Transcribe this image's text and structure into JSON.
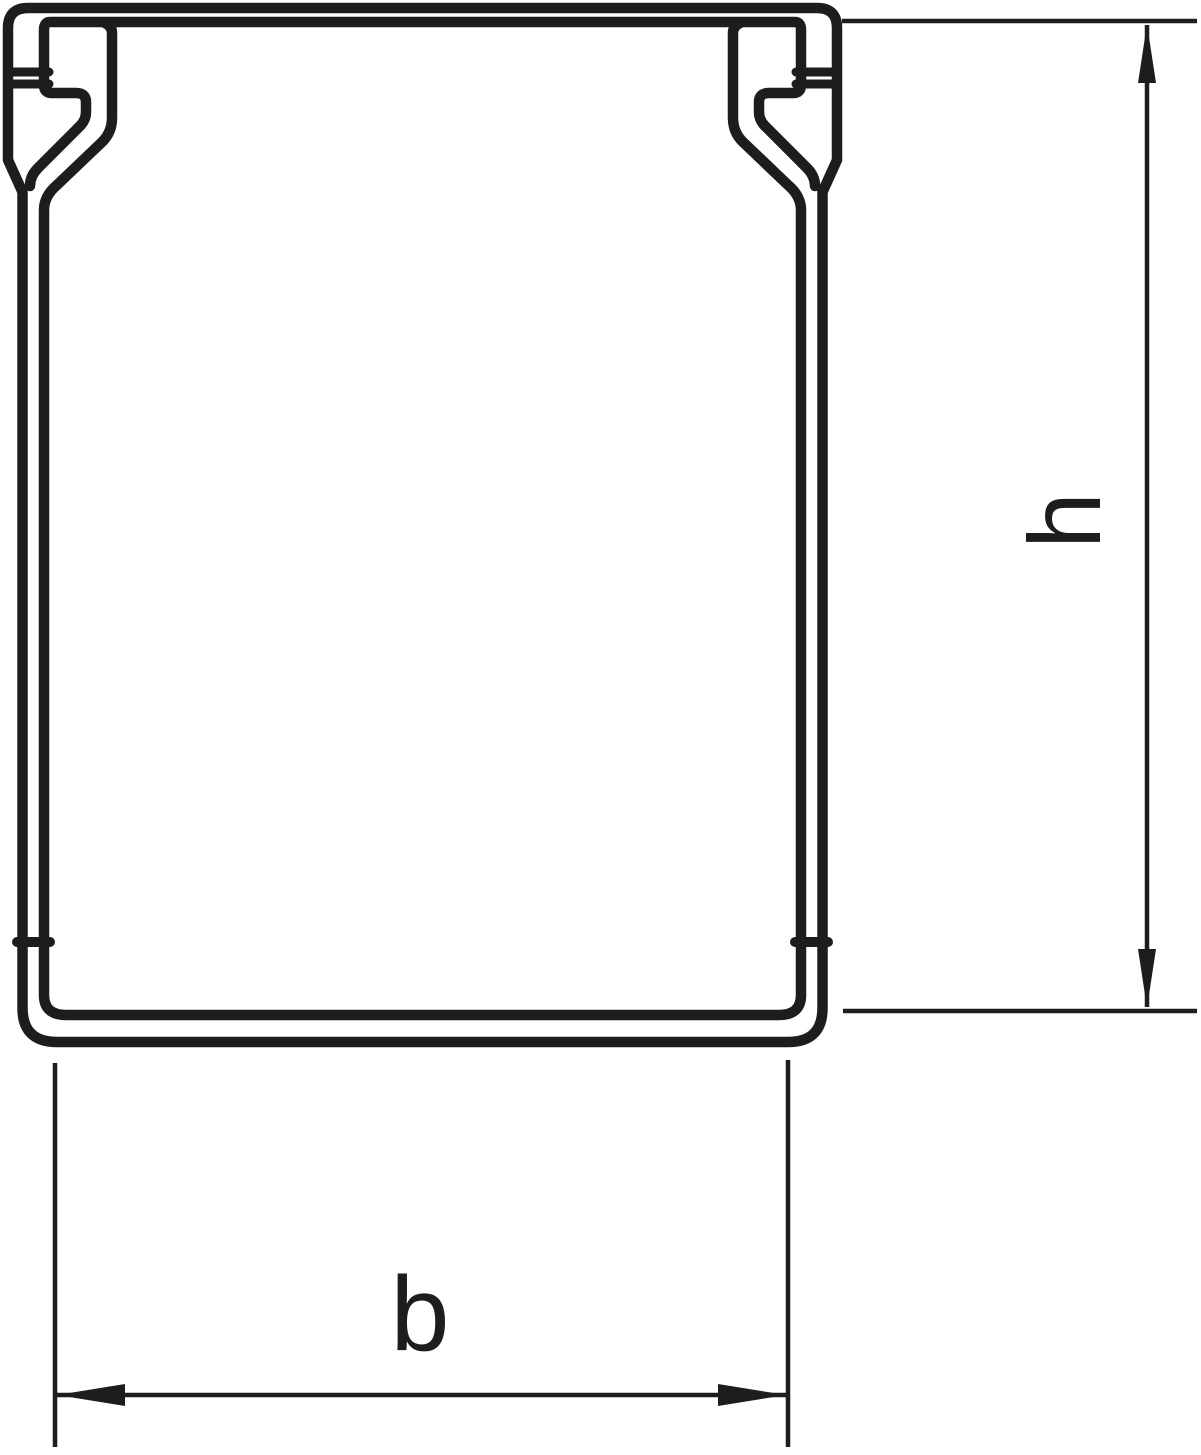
{
  "page": {
    "background_color": "#ffffff"
  },
  "drawing": {
    "line_color": "#1d1d1b",
    "labels": {
      "height_dimension": "h",
      "width_dimension": "b"
    }
  }
}
